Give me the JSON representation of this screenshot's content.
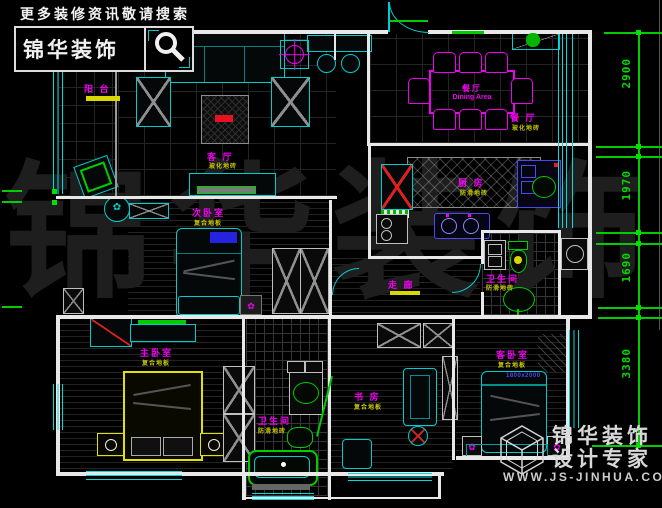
{
  "header": {
    "search_hint": "更多装修资讯敬请搜索",
    "logo": "锦华装饰"
  },
  "watermark": "锦华装饰",
  "rooms": {
    "balcony": {
      "name": "阳 台"
    },
    "living": {
      "name": "客 厅",
      "floor": "玻化地砖"
    },
    "dining": {
      "table_cn": "餐厅",
      "table_en": "Dining Area",
      "name": "餐 厅",
      "floor": "玻化地砖"
    },
    "kitchen": {
      "name": "厨 房",
      "floor": "防滑地砖"
    },
    "bedroom2": {
      "name": "次卧室",
      "floor": "复合地板"
    },
    "corridor": {
      "name": "走 廊"
    },
    "bath1": {
      "name": "卫生间",
      "floor": "防滑地砖"
    },
    "master": {
      "name": "主卧室",
      "floor": "复合地板"
    },
    "bath2": {
      "name": "卫生间",
      "floor": "防滑地砖"
    },
    "study": {
      "name": "书 房",
      "floor": "复合地板"
    },
    "guest": {
      "name": "客卧室",
      "floor": "复合地板",
      "bed_size": "1800x2000"
    }
  },
  "dimensions": {
    "right": [
      "2900",
      "1970",
      "1690",
      "3380"
    ]
  },
  "brand": {
    "name": "锦华装饰",
    "tagline": "设计专家",
    "url": "WWW.JS-JINHUA.COM"
  },
  "colors": {
    "wall": "#e8e8e8",
    "window": "#00dcdc",
    "dimension": "#00cc00",
    "room_label": "#f000f0",
    "floor_label": "#c8c800",
    "bed_master": "#e2e200",
    "accent_red": "#e02020",
    "accent_blue": "#4a4aee",
    "fixture_green": "#00cc00"
  }
}
